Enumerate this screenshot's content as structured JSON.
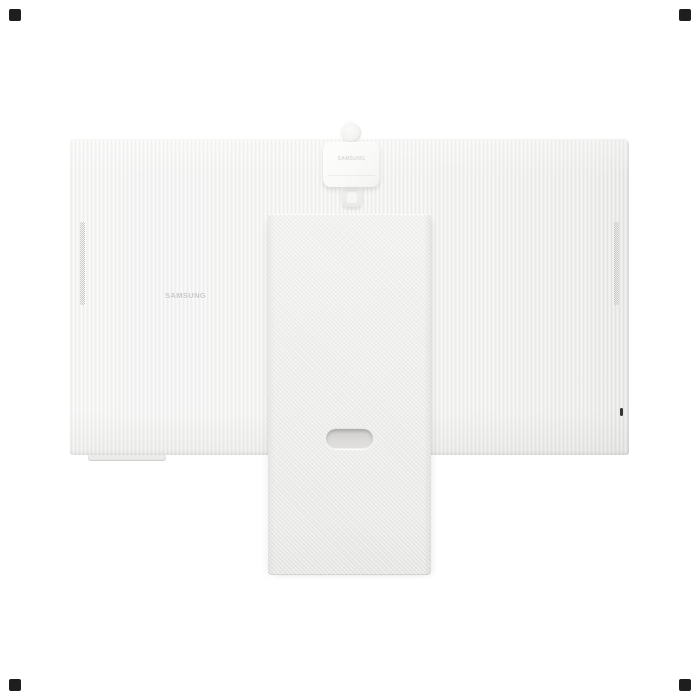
{
  "image": {
    "type": "product-photo",
    "subject": "Samsung smart monitor rear view with detachable webcam and stand"
  },
  "monitor": {
    "brand_logo": "SAMSUNG"
  },
  "webcam": {
    "brand_logo": "SAMSUNG"
  },
  "colors": {
    "background": "#ffffff",
    "panel_base": "#f4f4f2",
    "panel_right_shade": "#e3e3e1",
    "stand_base": "#eeeeec",
    "cable_hole": "#d8d7d5",
    "grille_dots": "#c5c7c6",
    "panel_logo_text": "#c6c9c8",
    "webcam_body": "#fbfbfa",
    "webcam_logo_text": "#d9d9d7",
    "power_button": "#343432",
    "corner_mark": "#1e1e1e"
  }
}
